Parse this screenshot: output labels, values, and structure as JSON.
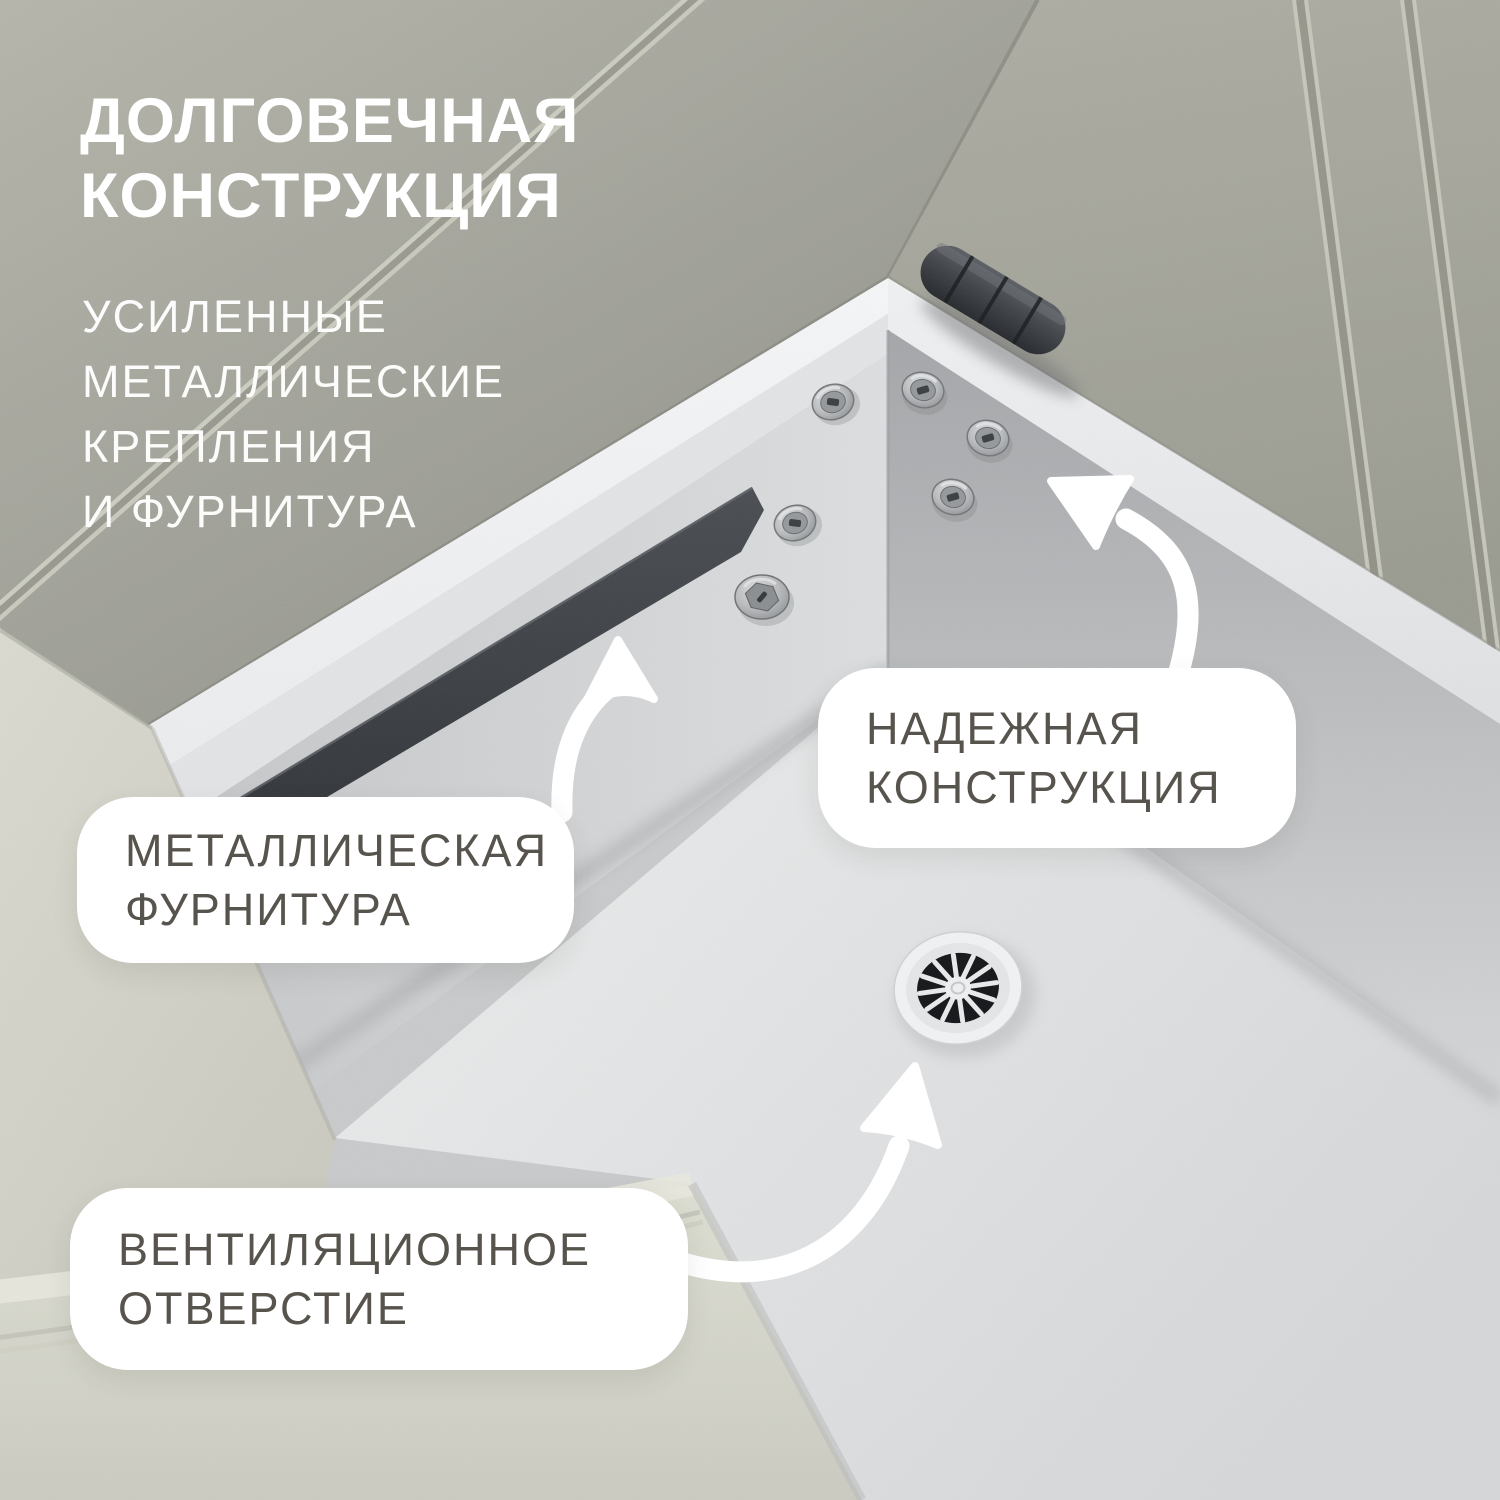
{
  "header": {
    "title_lines": [
      "ДОЛГОВЕЧНАЯ",
      "КОНСТРУКЦИЯ"
    ],
    "subtitle_lines": [
      "УСИЛЕННЫЕ",
      "МЕТАЛЛИЧЕСКИЕ",
      "КРЕПЛЕНИЯ",
      "И ФУРНИТУРА"
    ]
  },
  "callouts": {
    "metal_fittings": {
      "lines": [
        "МЕТАЛЛИЧЕСКАЯ",
        "ФУРНИТУРА"
      ]
    },
    "reliable_construction": {
      "lines": [
        "НАДЕЖНАЯ",
        "КОНСТРУКЦИЯ"
      ]
    },
    "vent_hole": {
      "lines": [
        "ВЕНТИЛЯЦИОННОЕ",
        "ОТВЕРСТИЕ"
      ]
    }
  },
  "scene_features": [
    "hinge",
    "screws",
    "hex-bolt",
    "metal-bracket",
    "vent-grille",
    "storage-box",
    "sofa-upholstery"
  ],
  "colors": {
    "title_text": "#ffffff",
    "subtitle_text": "#ffffff",
    "label_text": "#57534d",
    "label_bg": "#ffffff",
    "arrow": "#ffffff",
    "fabric_dark": "#a4a49a",
    "fabric_light": "#d7d7cd",
    "box_white": "#f2f3f4",
    "wall_gray": "#c3c5c7",
    "floor_gray": "#e4e5e6",
    "bracket_dark": "#3b3f44",
    "hinge_dark": "#2e3136",
    "vent_dark": "#15171a",
    "metal_silver": "#b9bbbd"
  }
}
